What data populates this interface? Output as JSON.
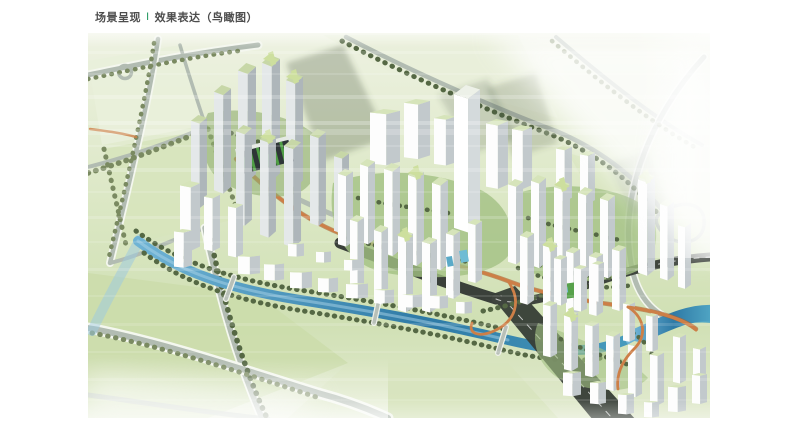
{
  "header": {
    "title_left": "场景呈现",
    "separator": "I",
    "title_right": "效果表达（鸟瞰图）"
  },
  "palette": {
    "page_bg": "#ffffff",
    "title_text": "#4d4d4d",
    "title_accent": "#2f9e68",
    "field_light": "#e9efda",
    "field_mid": "#d7e4bd",
    "field_deep": "#cbdcaa",
    "road_gray": "#b2bcb2",
    "road_casing": "#f4f7ef",
    "tree_green": "#7a8a61",
    "tree_dark": "#556844",
    "grass": "#a3c183",
    "park_green": "#57a14b",
    "building_front": "#fdfdfd",
    "building_side": "#c2c9cc",
    "roof_green": "#d6e4ba",
    "river_blue": "#3e8cb8",
    "river_light": "#9fcade",
    "orange_road": "#cd7f47",
    "dark_road": "#3a403a",
    "shadow": "#3f4f3a"
  }
}
